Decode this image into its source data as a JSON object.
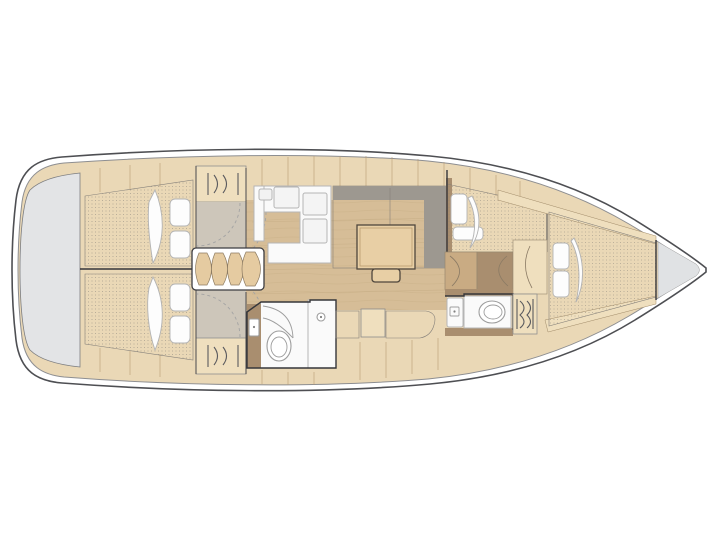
{
  "canvas": {
    "width": 720,
    "height": 540,
    "background": "#ffffff"
  },
  "diagram_type": "sailboat-interior-floorplan-top-view",
  "palette": {
    "hull_line": "#4e4f53",
    "platform_gray": "#e3e4e6",
    "bow_gray": "#e0e2e4",
    "wood_base": "#ead8b6",
    "wood_band": "#efdfbe",
    "wood_floor": "#d6bd97",
    "wood_dark": "#a98e6f",
    "wood_mid": "#c9ab83",
    "step_wood": "#e5cba1",
    "table_wood": "#e8cfa5",
    "mattress_gray": "#a7a199",
    "sofa_gray": "#b2aea6",
    "sofa_gray_dark": "#9d9890",
    "linen_white": "#fdfdfd",
    "unit_white": "#fafafa",
    "vestibule_gray": "#cdc6ba"
  },
  "icons": {
    "hanging_locker": "rails-with-wavy-hangers",
    "shower": "quarter-arc",
    "toilet": "oval-bowl",
    "sink": "square-basin-with-drain-dot"
  },
  "regions": [
    "swim-platform",
    "aft-cabin-port",
    "aft-cabin-starboard",
    "companionway-steps",
    "galley",
    "dinette",
    "aft-head",
    "starboard-settee",
    "forward-berth-port",
    "forward-head",
    "wardrobe",
    "bow-cabin",
    "anchor-locker"
  ]
}
